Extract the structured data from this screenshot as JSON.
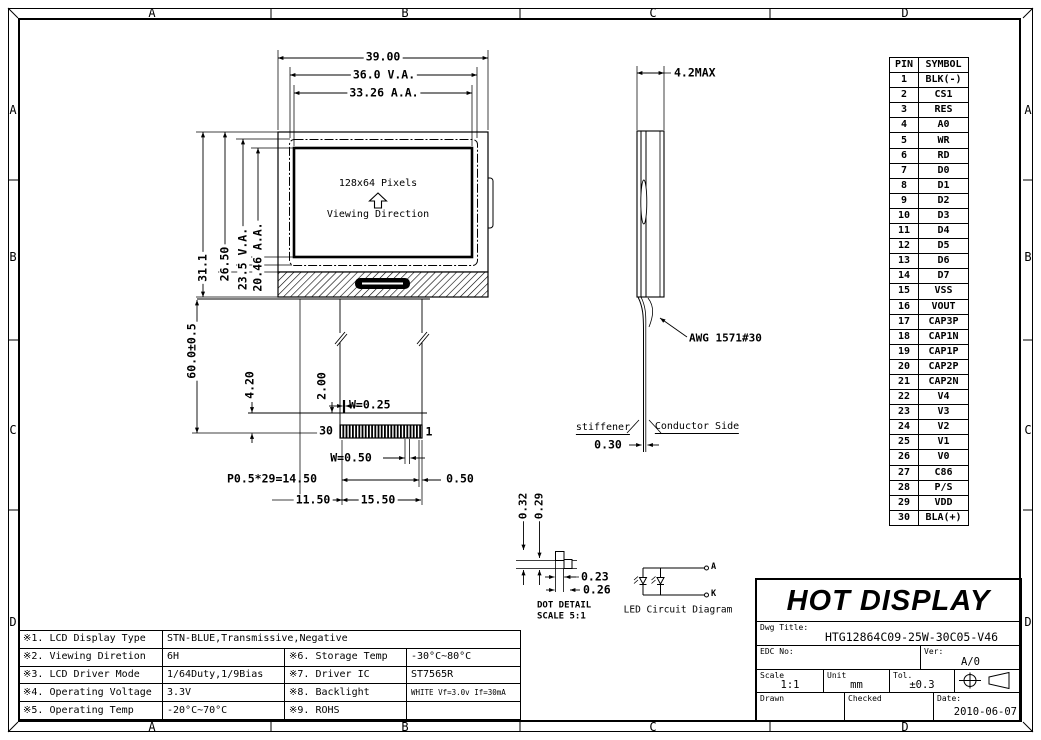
{
  "zones": {
    "top": [
      "A",
      "B",
      "C",
      "D"
    ],
    "bottom": [
      "A",
      "B",
      "C",
      "D"
    ],
    "left": [
      "A",
      "B",
      "C",
      "D"
    ],
    "right": [
      "A",
      "B",
      "C",
      "D"
    ]
  },
  "front_view": {
    "pixels_label": "128x64 Pixels",
    "viewing_label": "Viewing Direction",
    "dim_width_outline": "39.00",
    "dim_width_va": "36.0 V.A.",
    "dim_width_aa": "33.26 A.A.",
    "dim_height_outline": "31.1",
    "dim_height_glass": "26.50",
    "dim_height_va": "23.5 V.A.",
    "dim_height_aa": "20.46 A.A."
  },
  "fpc": {
    "dim_length": "60.0±0.5",
    "dim_stiffener": "4.20",
    "dim_tail": "2.00",
    "dim_trace_width": "W=0.25",
    "dim_pin_width": "W=0.50",
    "dim_pitch": "P0.5*29=14.50",
    "dim_end_margin": "0.50",
    "dim_offset": "11.50",
    "dim_connector_width": "15.50",
    "pin_first": "30",
    "pin_last": "1"
  },
  "side_view": {
    "dim_thickness": "4.2MAX",
    "wire_label": "AWG 1571#30",
    "stiffener_label": "stiffener",
    "conductor_label": "Conductor Side",
    "dim_fpc_thickness": "0.30"
  },
  "dot_detail": {
    "dim_col1": "0.32",
    "dim_col2": "0.29",
    "dim_row1": "0.23",
    "dim_row2": "0.26",
    "title": "DOT DETAIL",
    "scale_note": "SCALE 5:1"
  },
  "led_circuit": {
    "anode_label": "A",
    "cathode_label": "K",
    "title": "LED Circuit Diagram"
  },
  "pin_table": {
    "headers": [
      "PIN",
      "SYMBOL"
    ],
    "rows": [
      [
        "1",
        "BLK(-)"
      ],
      [
        "2",
        "CS1"
      ],
      [
        "3",
        "RES"
      ],
      [
        "4",
        "A0"
      ],
      [
        "5",
        "WR"
      ],
      [
        "6",
        "RD"
      ],
      [
        "7",
        "D0"
      ],
      [
        "8",
        "D1"
      ],
      [
        "9",
        "D2"
      ],
      [
        "10",
        "D3"
      ],
      [
        "11",
        "D4"
      ],
      [
        "12",
        "D5"
      ],
      [
        "13",
        "D6"
      ],
      [
        "14",
        "D7"
      ],
      [
        "15",
        "VSS"
      ],
      [
        "16",
        "VOUT"
      ],
      [
        "17",
        "CAP3P"
      ],
      [
        "18",
        "CAP1N"
      ],
      [
        "19",
        "CAP1P"
      ],
      [
        "20",
        "CAP2P"
      ],
      [
        "21",
        "CAP2N"
      ],
      [
        "22",
        "V4"
      ],
      [
        "23",
        "V3"
      ],
      [
        "24",
        "V2"
      ],
      [
        "25",
        "V1"
      ],
      [
        "26",
        "V0"
      ],
      [
        "27",
        "C86"
      ],
      [
        "28",
        "P/S"
      ],
      [
        "29",
        "VDD"
      ],
      [
        "30",
        "BLA(+)"
      ]
    ]
  },
  "spec_table": {
    "rows": [
      [
        "※1. LCD Display Type",
        "STN-BLUE,Transmissive,Negative",
        "",
        ""
      ],
      [
        "※2. Viewing Diretion",
        "6H",
        "※6. Storage Temp",
        "-30°C~80°C"
      ],
      [
        "※3. LCD Driver Mode",
        "1/64Duty,1/9Bias",
        "※7. Driver IC",
        "ST7565R"
      ],
      [
        "※4. Operating Voltage",
        "3.3V",
        "※8. Backlight",
        "WHITE Vf=3.0v If=30mA"
      ],
      [
        "※5. Operating Temp",
        "-20°C~70°C",
        "※9. ROHS",
        ""
      ]
    ]
  },
  "title_block": {
    "company": "HOT DISPLAY",
    "dwg_title_label": "Dwg Title:",
    "dwg_title": "HTG12864C09-25W-30C05-V46",
    "edc_label": "EDC No:",
    "ver_label": "Ver:",
    "ver": "A/0",
    "scale_label": "Scale",
    "scale": "1:1",
    "unit_label": "Unit",
    "unit": "mm",
    "tol_label": "Tol.",
    "tol": "±0.3",
    "drawn_label": "Drawn",
    "checked_label": "Checked",
    "date_label": "Date:",
    "date": "2010-06-07"
  }
}
